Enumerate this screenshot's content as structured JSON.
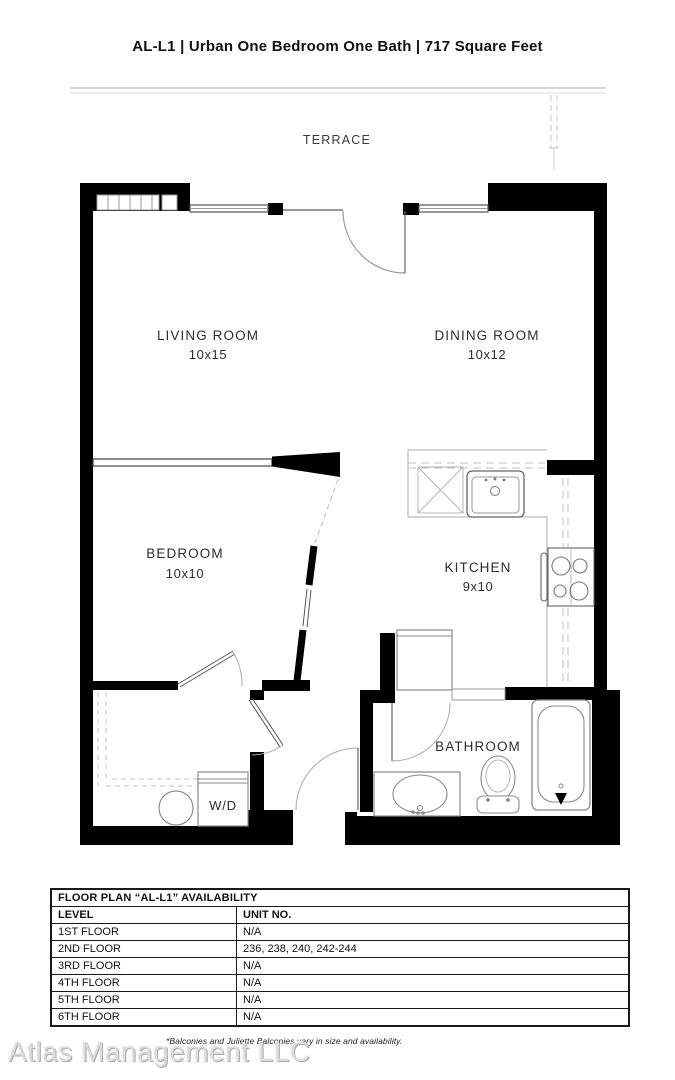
{
  "header": {
    "title": "AL-L1 | Urban One Bedroom One Bath | 717 Square Feet"
  },
  "floor_plan": {
    "terrace_label": "TERRACE",
    "rooms": [
      {
        "name": "LIVING ROOM",
        "dimensions": "10x15"
      },
      {
        "name": "DINING ROOM",
        "dimensions": "10x12"
      },
      {
        "name": "BEDROOM",
        "dimensions": "10x10"
      },
      {
        "name": "KITCHEN",
        "dimensions": "9x10"
      },
      {
        "name": "BATHROOM",
        "dimensions": ""
      },
      {
        "name": "W/D",
        "dimensions": ""
      }
    ],
    "fixtures": [
      "baseboard-heater",
      "terrace-door",
      "dishwasher",
      "kitchen-sink",
      "stove",
      "refrigerator",
      "washer-dryer",
      "vanity-sink",
      "toilet",
      "bathtub"
    ]
  },
  "availability_table": {
    "title": "FLOOR PLAN “AL-L1” AVAILABILITY",
    "columns": [
      "LEVEL",
      "UNIT NO."
    ],
    "rows": [
      {
        "level": "1ST FLOOR",
        "unit_no": "N/A"
      },
      {
        "level": "2ND FLOOR",
        "unit_no": "236, 238, 240, 242-244"
      },
      {
        "level": "3RD FLOOR",
        "unit_no": "N/A"
      },
      {
        "level": "4TH FLOOR",
        "unit_no": "N/A"
      },
      {
        "level": "5TH FLOOR",
        "unit_no": "N/A"
      },
      {
        "level": "6TH FLOOR",
        "unit_no": "N/A"
      }
    ]
  },
  "footer": {
    "note": "*Balconies and Juliette Balconies vary in size and availability.",
    "watermark": "Atlas Management LLC"
  },
  "colors": {
    "wall": "#000000",
    "fixture_line": "#8a8a8a",
    "dashed_line": "#c4c4c4",
    "text": "#2e2e2e",
    "watermark": "#dcdcdc"
  }
}
